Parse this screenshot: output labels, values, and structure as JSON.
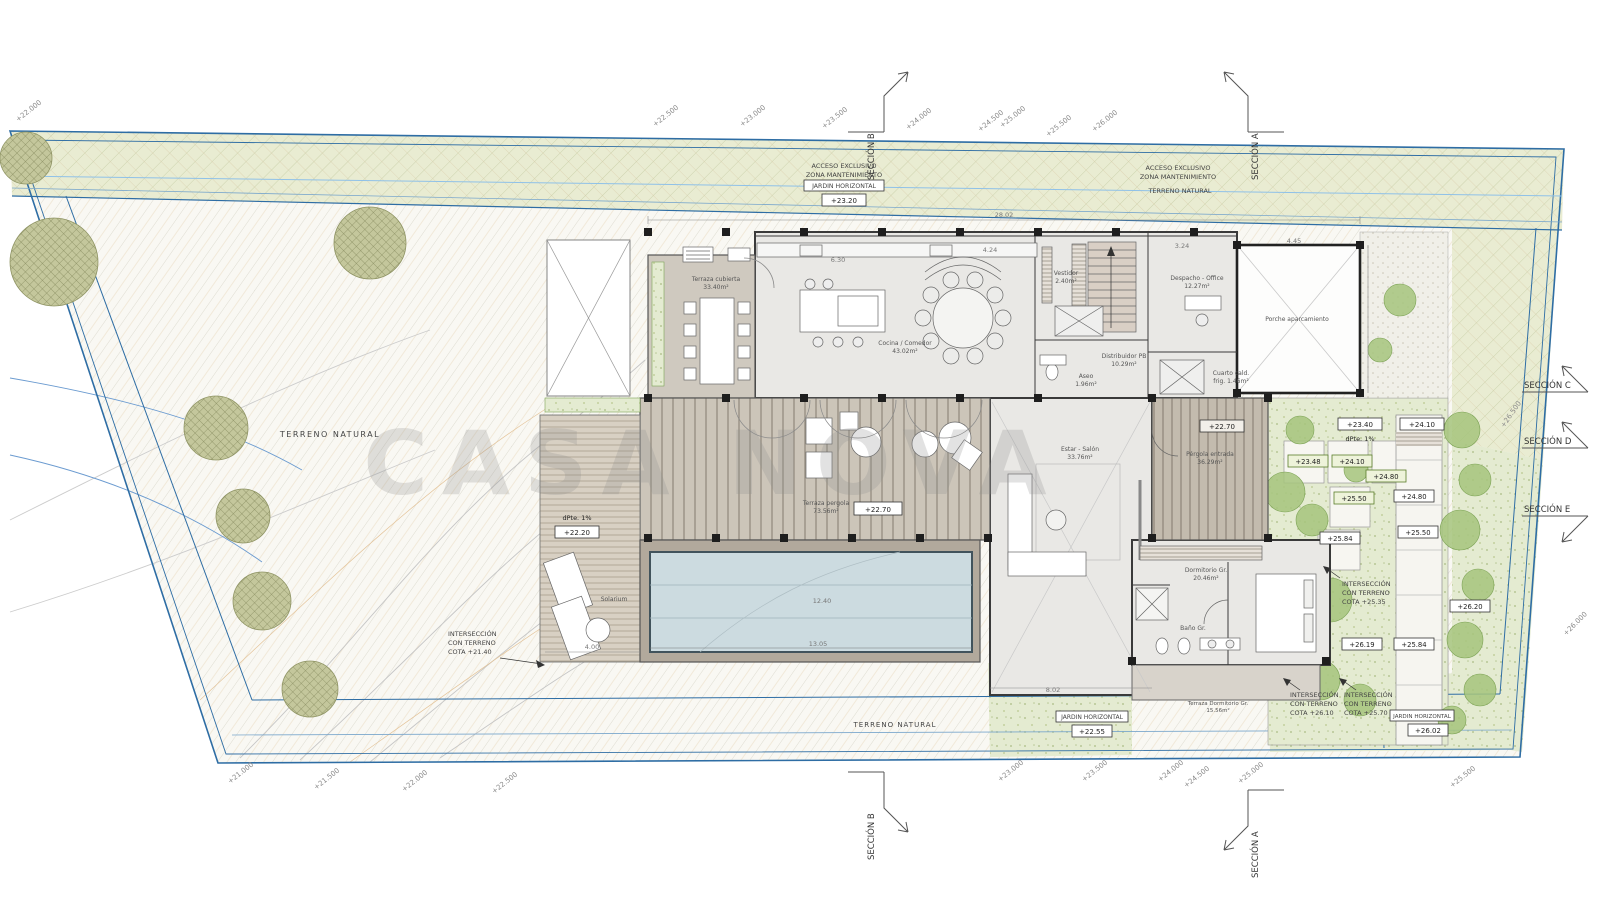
{
  "watermark": "CASA NOVA",
  "sections": {
    "a": "SECCIÓN A",
    "b": "SECCIÓN B",
    "c": "SECCIÓN C",
    "d": "SECCIÓN D",
    "e": "SECCIÓN E"
  },
  "site_labels": {
    "acceso_left_1": "ACCESO EXCLUSIVO",
    "acceso_left_2": "ZONA MANTENIMIENTO",
    "acceso_right_1": "ACCESO EXCLUSIVO",
    "acceso_right_2": "ZONA MANTENIMIENTO",
    "jardin_horizontal_top": "JARDIN HORIZONTAL",
    "terreno_natural_top": "TERRENO NATURAL",
    "terreno_natural_left": "TERRENO NATURAL",
    "terreno_natural_bottom": "TERRENO NATURAL",
    "jardin_horizontal_bottom": "JARDIN HORIZONTAL",
    "jardin_horizontal_bottom_right": "JARDIN HORIZONTAL"
  },
  "cotas": {
    "top": "+23.20",
    "deck_slope": "dPte.  1%",
    "deck": "+22.20",
    "pergola_terrace": "+22.70",
    "entry_pergola": "+22.70",
    "entry_landing": "+23.40",
    "entry_slope": "dPte.  1%",
    "entry_step": "+24.10",
    "garden_1": "+23.48",
    "garden_2": "+24.10",
    "garden_3": "+24.80",
    "garden_4": "+25.50",
    "garden_5": "+25.84",
    "path_1": "+24.80",
    "path_2": "+25.50",
    "path_3": "+26.20",
    "path_4": "+26.19",
    "path_5": "+25.84",
    "bottom_garden": "+22.55",
    "bottom_right_garden": "+26.02"
  },
  "intersections": {
    "left": [
      "INTERSECCIÓN",
      "CON TERRENO",
      "COTA  +21.40"
    ],
    "right": [
      "INTERSECCIÓN",
      "CON TERRENO",
      "COTA +25.35"
    ],
    "bottom_1": [
      "INTERSECCIÓN",
      "CON TERRENO",
      "COTA +26.10"
    ],
    "bottom_2": [
      "INTERSECCIÓN",
      "CON TERRENO",
      "COTA +25.70"
    ]
  },
  "rooms": {
    "terraza_cubierta": [
      "Terraza cubierta",
      "33.40m²"
    ],
    "cocina": [
      "Cocina / Comedor",
      "43.02m²"
    ],
    "vestidor": [
      "Vestidor",
      "2.40m²"
    ],
    "despacho": [
      "Despacho - Office",
      "12.27m²"
    ],
    "distribuidor": [
      "Distribuidor PB",
      "10.29m²"
    ],
    "aseo": [
      "Aseo",
      "1.96m²"
    ],
    "cuarto_instalaciones": [
      "Cuarto cald.",
      "frig. 1.46m²"
    ],
    "porche": [
      "Porche aparcamiento",
      ""
    ],
    "terraza_pergola": [
      "Terraza pergola",
      "73.56m²"
    ],
    "estar": [
      "Estar - Salón",
      "33.76m²"
    ],
    "pergola_entrada": [
      "Pérgola entrada",
      "36.29m²"
    ],
    "dormitorio": [
      "Dormitorio Gr.",
      "20.46m²"
    ],
    "bano": [
      "Baño Gr.",
      "5.24m²"
    ],
    "solarium": [
      "Solarium",
      ""
    ],
    "terraza_dormitorio": [
      "Terraza Dormitorio Gr.",
      "15.56m²"
    ]
  },
  "dimensions": {
    "total_top": "28.02",
    "kitchen": "6.30",
    "dining": "4.24",
    "office": "3.24",
    "carport": "4.45",
    "pool_top": "12.40",
    "pool_bottom": "13.05",
    "deck": "4.00",
    "living_bottom": "8.02"
  },
  "contours": {
    "top": [
      "+22.500",
      "+23.000",
      "+23.500",
      "+24.000",
      "+24.500",
      "+25.000",
      "+25.500",
      "+26.000"
    ],
    "bottom": [
      "+21.000",
      "+21.500",
      "+22.000",
      "+22.500",
      "+23.000",
      "+23.500",
      "+24.000",
      "+24.500",
      "+25.000",
      "+25.500"
    ],
    "left": "+22.000",
    "right_upper": "+26.500",
    "right_lower": "+26.000"
  },
  "colors": {
    "boundary_blue": "#2e6da4",
    "band_green": "#e9ecd2",
    "pool_blue": "#ccdbe0",
    "terrace_brown": "#c7c0b4",
    "floor_grey": "#e9e8e5",
    "tree_olive": "#c4c79c",
    "garden_green": "#e4ebd1"
  }
}
